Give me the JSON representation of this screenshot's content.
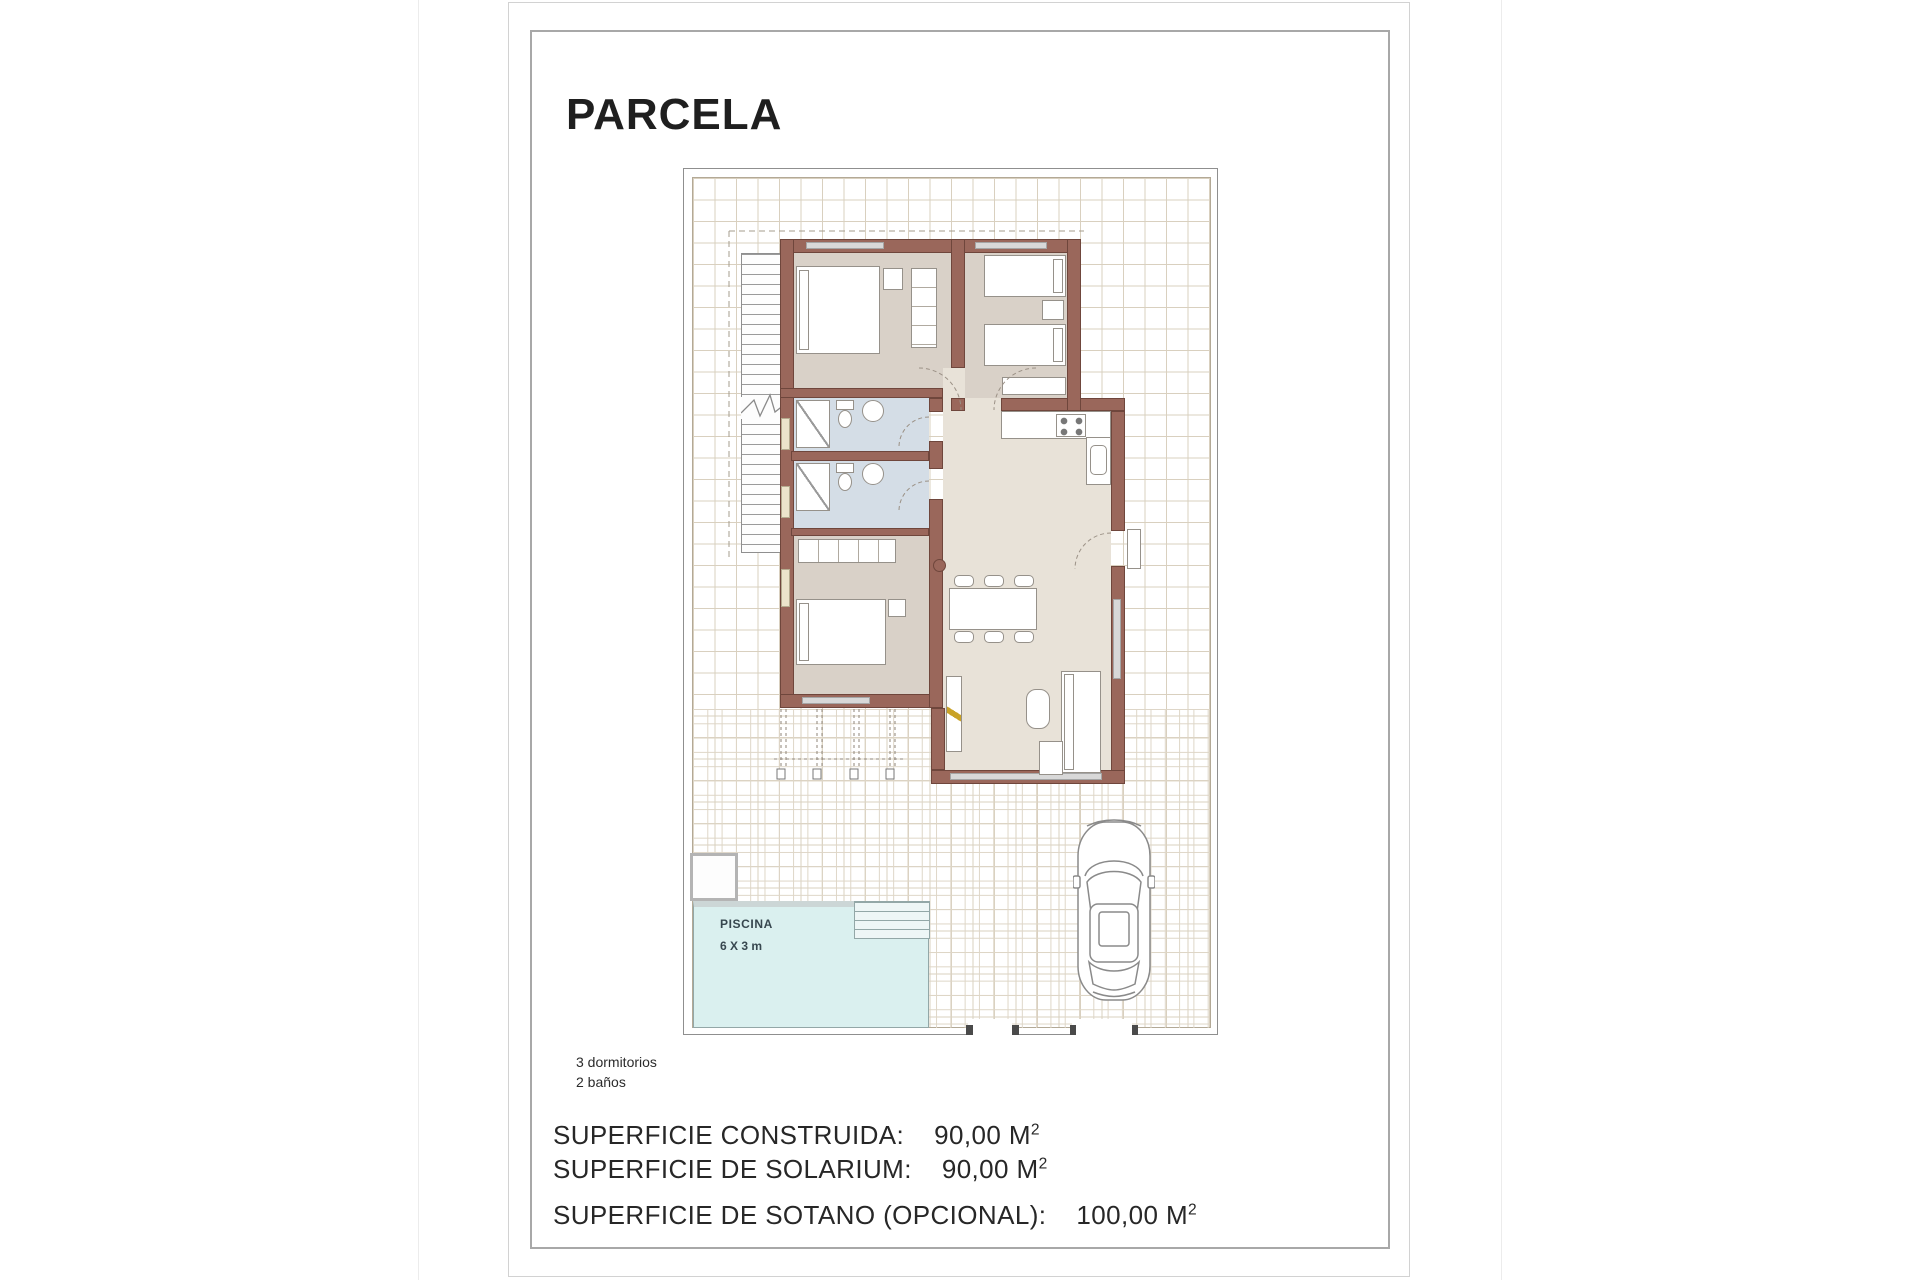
{
  "title": "PARCELA",
  "plan": {
    "pool": {
      "label": "PISCINA",
      "dimensions": "6 X 3 m"
    }
  },
  "features": {
    "bedrooms": "3 dormitorios",
    "bathrooms": "2 baños"
  },
  "areas": [
    {
      "label": "SUPERFICIE CONSTRUIDA:",
      "value": "90,00 M",
      "sup": "2"
    },
    {
      "label": "SUPERFICIE DE SOLARIUM:",
      "value": "90,00 M",
      "sup": "2"
    },
    {
      "label": "SUPERFICIE DE SOTANO (OPCIONAL):",
      "value": "100,00 M",
      "sup": "2"
    }
  ],
  "colors": {
    "wall": "#9a675b",
    "bedroom_floor": "#d9d1c8",
    "bathroom_floor": "#d4dde6",
    "living_floor": "#e8e2d8",
    "pool": "#daf0ef",
    "grid_line": "#d9d0bf"
  }
}
